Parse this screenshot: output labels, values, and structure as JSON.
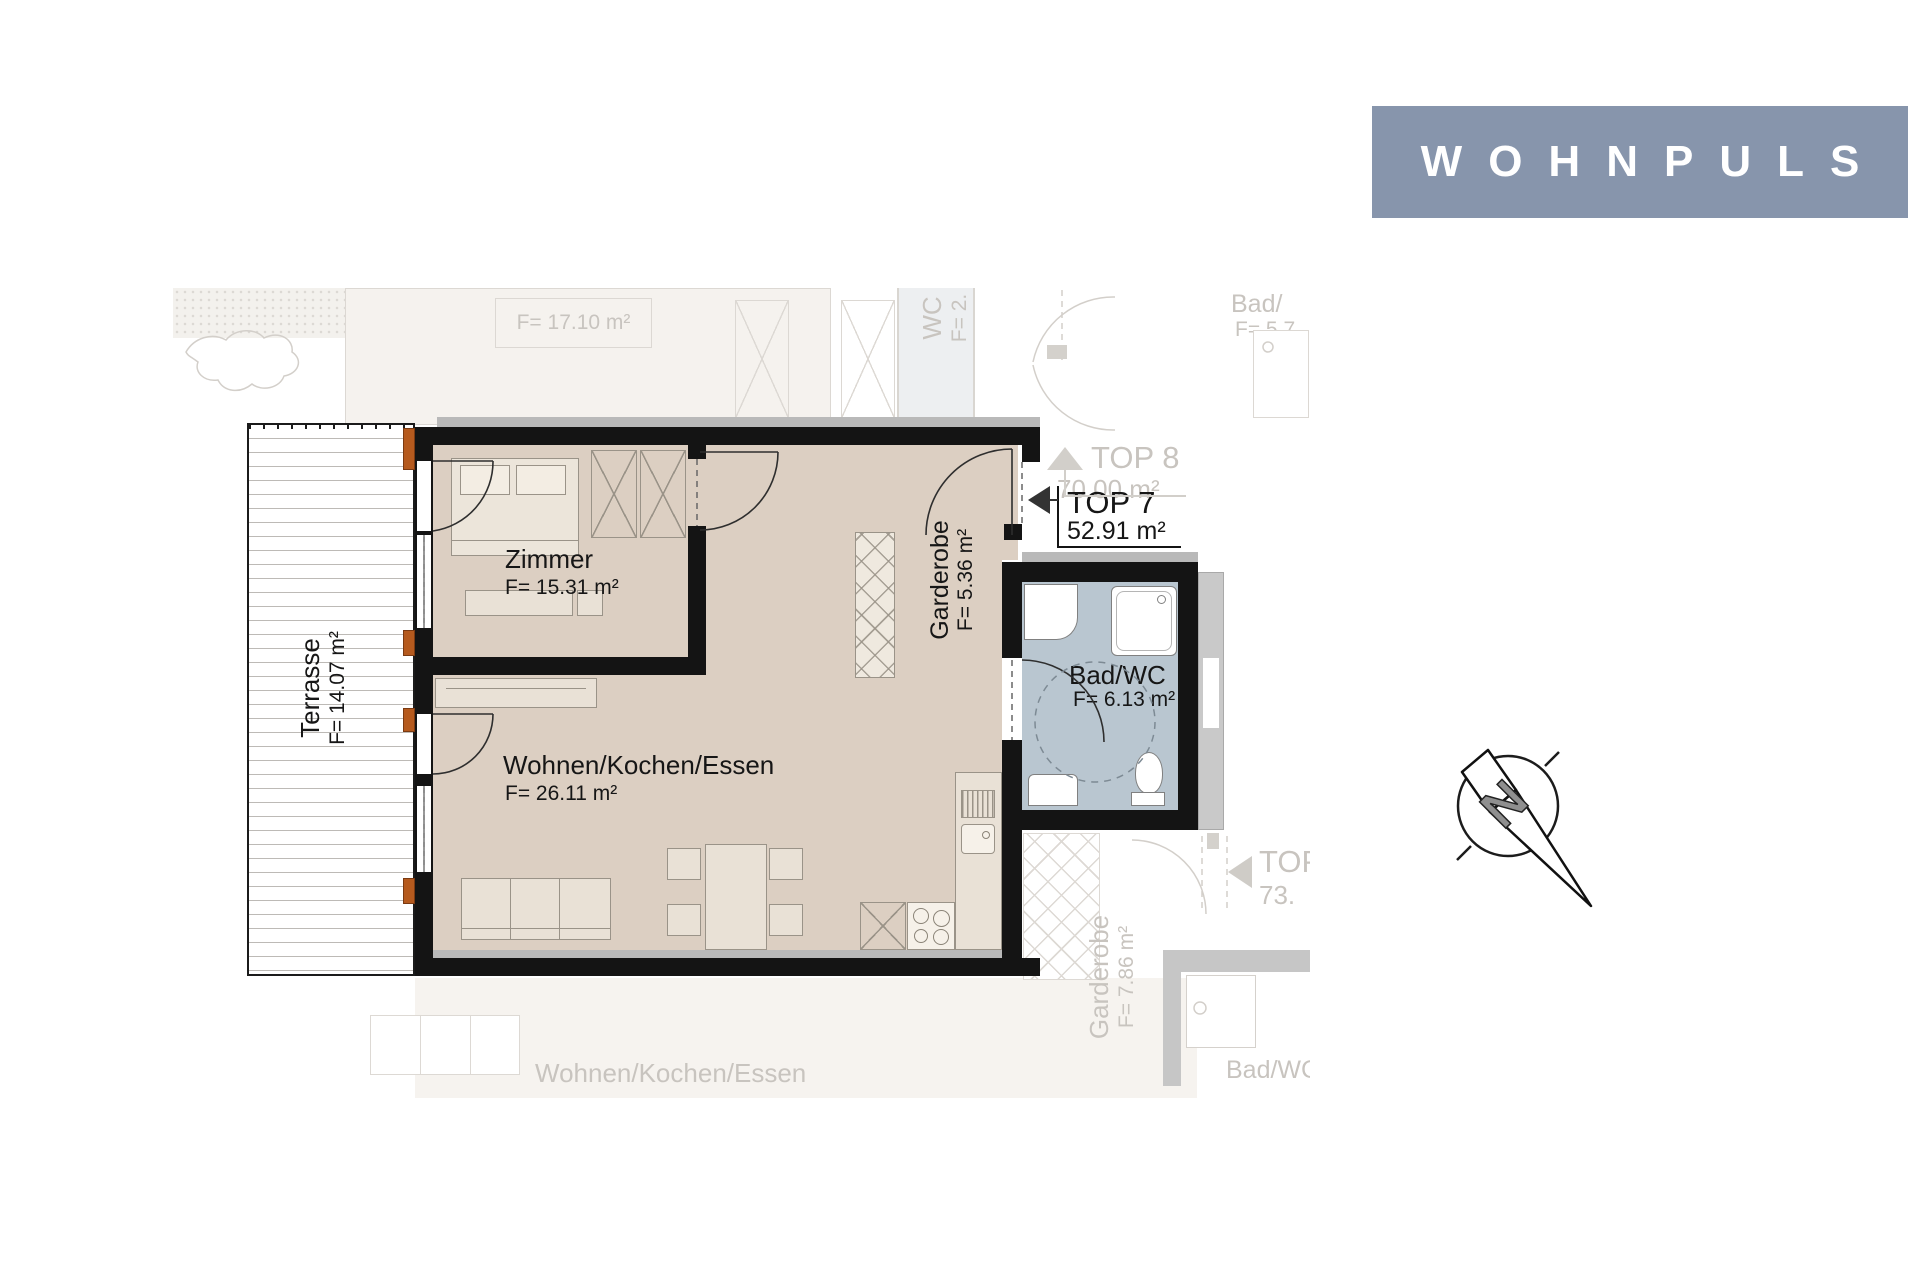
{
  "brand": {
    "name": "WOHNPULS"
  },
  "plan": {
    "unit": {
      "label": "TOP 7",
      "area": "52.91 m²"
    },
    "rooms": {
      "zimmer": {
        "name": "Zimmer",
        "area": "F= 15.31 m²"
      },
      "terrasse": {
        "name": "Terrasse",
        "area": "F= 14.07 m²"
      },
      "garderobe": {
        "name": "Garderobe",
        "area": "F= 5.36 m²"
      },
      "wohnen": {
        "name": "Wohnen/Kochen/Essen",
        "area": "F= 26.11 m²"
      },
      "bad": {
        "name": "Bad/WC",
        "area": "F= 6.13 m²"
      }
    },
    "adjacent": {
      "top8": {
        "label": "TOP 8",
        "area": "70.00 m²"
      },
      "room_top_area": "F= 17.10 m²",
      "wc": {
        "name": "WC",
        "area": "F= 2."
      },
      "bad_top": {
        "name": "Bad/",
        "area": "F= 5.7"
      },
      "neighbor": {
        "label": "TOP",
        "area": "73."
      },
      "garderobe": {
        "name": "Garderobe",
        "area": "F= 7.86 m²"
      },
      "bad_bottom": "Bad/WC",
      "wohnen_bottom": "Wohnen/Kochen/Essen"
    },
    "compass_letter": "N"
  },
  "colors": {
    "banner_bg": "#8795ac",
    "room_fill": "#dccfc2",
    "bath_fill": "#b9c6d0",
    "wall": "#141414",
    "window_accent": "#b55a1e",
    "faded_line": "#d5d1cc",
    "faded_text": "#c8c4bf"
  }
}
